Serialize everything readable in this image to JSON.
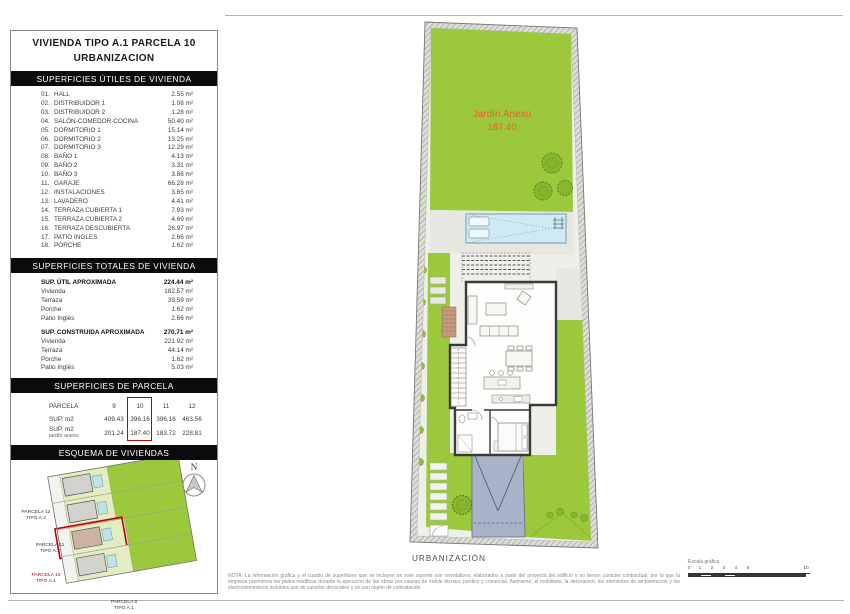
{
  "panel": {
    "title_line1": "VIVIENDA TIPO A.1 PARCELA 10",
    "title_line2": "URBANIZACION",
    "sections": {
      "utiles": "SUPERFICIES ÚTILES DE VIVIENDA",
      "totales": "SUPERFICIES TOTALES DE VIVIENDA",
      "parcela": "SUPERFICIES DE PARCELA",
      "esquema": "ESQUEMA DE VIVIENDAS"
    },
    "rooms": [
      {
        "num": "01.",
        "name": "HALL",
        "area": "2.55 m²"
      },
      {
        "num": "02.",
        "name": "DISTRIBUIDOR 1",
        "area": "1.08 m²"
      },
      {
        "num": "03.",
        "name": "DISTRIBUIDOR 2",
        "area": "1.28 m²"
      },
      {
        "num": "04.",
        "name": "SALÓN-COMEDOR-COCINA",
        "area": "50.40 m²"
      },
      {
        "num": "05.",
        "name": "DORMITORIO 1",
        "area": "15.14 m²"
      },
      {
        "num": "06.",
        "name": "DORMITORIO 2",
        "area": "13.25 m²"
      },
      {
        "num": "07.",
        "name": "DORMITORIO 3",
        "area": "12.29 m²"
      },
      {
        "num": "08.",
        "name": "BAÑO 1",
        "area": "4.13 m²"
      },
      {
        "num": "09.",
        "name": "BAÑO 2",
        "area": "3.31 m²"
      },
      {
        "num": "10.",
        "name": "BAÑO 3",
        "area": "3.86 m²"
      },
      {
        "num": "11.",
        "name": "GARAJE",
        "area": "66.28 m²"
      },
      {
        "num": "12.",
        "name": "INSTALACIONES",
        "area": "3.65 m²"
      },
      {
        "num": "13.",
        "name": "LAVADERO",
        "area": "4.41 m²"
      },
      {
        "num": "14.",
        "name": "TERRAZA CUBIERTA 1",
        "area": "7.93 m²"
      },
      {
        "num": "15.",
        "name": "TERRAZA CUBIERTA 2",
        "area": "4.69 m²"
      },
      {
        "num": "16.",
        "name": "TERRAZA DESCUBIERTA",
        "area": "26.97 m²"
      },
      {
        "num": "17.",
        "name": "PATIO INGLES",
        "area": "2.66 m²"
      },
      {
        "num": "18.",
        "name": "PORCHE",
        "area": "1.62 m²"
      }
    ],
    "totals": {
      "util": {
        "label": "SUP. ÚTIL APROXIMADA",
        "value": "224.44 m²",
        "items": [
          {
            "label": "Vivienda",
            "value": "182.57 m²"
          },
          {
            "label": "Terraza",
            "value": "39.59 m²"
          },
          {
            "label": "Porche",
            "value": "1.62 m²"
          },
          {
            "label": "Patio Inglés",
            "value": "2.66 m²"
          }
        ]
      },
      "construida": {
        "label": "SUP. CONSTRUIDA APROXIMADA",
        "value": "270.71 m²",
        "items": [
          {
            "label": "Vivienda",
            "value": "221.92 m²"
          },
          {
            "label": "Terraza",
            "value": "44.14 m²"
          },
          {
            "label": "Porche",
            "value": "1.62 m²"
          },
          {
            "label": "Patio Inglés",
            "value": "5.03 m²"
          }
        ]
      }
    },
    "parcela_table": {
      "header_label": "PARCELA",
      "columns": [
        "9",
        "10",
        "11",
        "12"
      ],
      "highlighted_column": "10",
      "row_sup_label": "SUP. m2",
      "row_sup_values": [
        "409.43",
        "396.16",
        "396.16",
        "463.56"
      ],
      "row_jardin_label": "SUP. m2",
      "row_jardin_sublabel": "jardín anexo",
      "row_jardin_values": [
        "201.24",
        "187.40",
        "183.72",
        "228.81"
      ]
    },
    "esquema": {
      "compass": "N",
      "parcels": [
        {
          "name": "PARCELA 12",
          "tipo": "TIPO A.2"
        },
        {
          "name": "PARCELA 11",
          "tipo": "TIPO A.2"
        },
        {
          "name": "PARCELA 10",
          "tipo": "TIPO A.1"
        },
        {
          "name": "PARCELA 9",
          "tipo": "TIPO A.1"
        }
      ],
      "edition": "Ed. 01/2024"
    }
  },
  "plan": {
    "jardin_label": "Jardín Anexo",
    "jardin_value": "187.40",
    "bottom_label": "URBANIZACIÓN"
  },
  "footer": {
    "note": "NOTA: La información gráfica y el cuadro de superficies que se incluyen en este soporte son orientativos, elaborados a partir del proyecto del edificio y no tienen carácter contractual, por lo que la empresa promotora los podrá modificar durante la ejecución de las obras por causas de índole técnico, jurídico y comercial. Asimismo, el mobiliario, la decoracion, los elementos de ambientacion y los electrodomesticos incluidos son de caracter decorativo y no son objeto de contratación.",
    "scale_label": "Escala gráfica",
    "scale_ticks": [
      "0",
      "1",
      "2",
      "3",
      "4",
      "5",
      "10"
    ]
  },
  "colors": {
    "garden_green": "#9cc83c",
    "pale_green": "#e3edc0",
    "pool_blue": "#cfeaf4",
    "driveway_gray": "#a9b3c7",
    "accent_red": "#c00000",
    "label_orange": "#e8612c"
  }
}
